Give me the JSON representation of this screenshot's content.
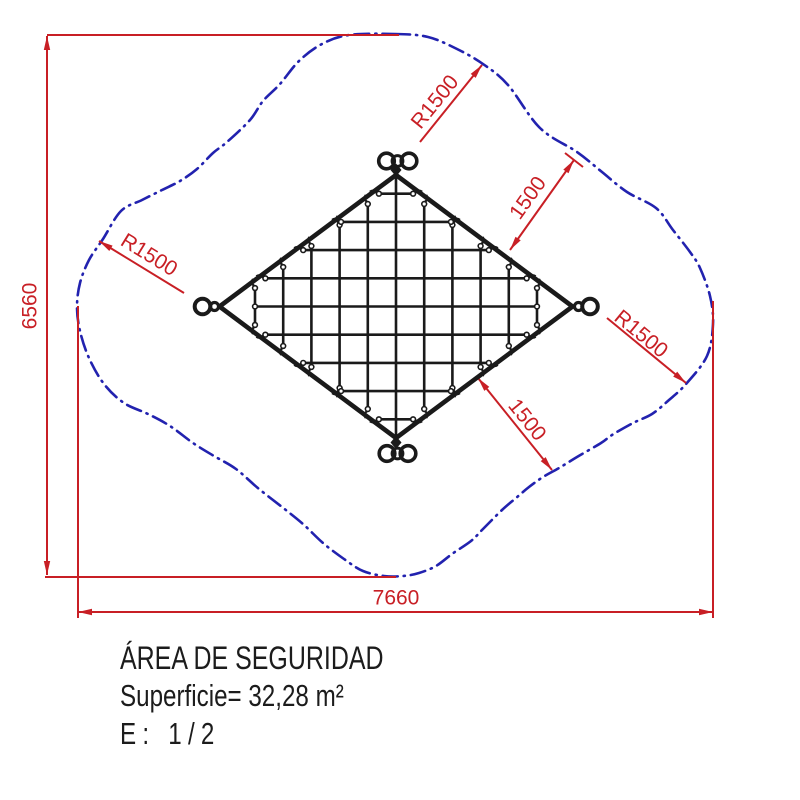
{
  "title_block": {
    "line1": "ÁREA DE SEGURIDAD",
    "line2": "Superficie= 32,28 m²",
    "line3": "E: 1/2"
  },
  "colors": {
    "red": "#c81f25",
    "blue": "#2222af",
    "black": "#1a1a1a",
    "bg": "#ffffff"
  },
  "dimensions": {
    "v6560": {
      "label": "6560",
      "line": [
        47,
        36,
        47,
        575
      ],
      "arrows": [
        [
          47,
          36,
          -90
        ],
        [
          47,
          575,
          90
        ]
      ],
      "ext": [
        [
          47,
          35,
          399,
          35
        ],
        [
          45,
          577,
          396,
          577
        ]
      ],
      "text": {
        "x": 30,
        "y": 306,
        "rot": -90
      }
    },
    "h7660": {
      "label": "7660",
      "line": [
        78,
        612,
        713,
        612
      ],
      "arrows": [
        [
          78,
          612,
          180
        ],
        [
          713,
          612,
          0
        ]
      ],
      "ext": [
        [
          78,
          306,
          78,
          618
        ],
        [
          713,
          301,
          713,
          618
        ]
      ],
      "text": {
        "x": 396,
        "y": 598,
        "rot": 0
      }
    },
    "r1500_ul": {
      "label": "R1500",
      "line": [
        99,
        241,
        184,
        293
      ],
      "arrows": [
        [
          99,
          241,
          211.5
        ]
      ],
      "text": {
        "x": 149,
        "y": 255,
        "rot": 31.5
      }
    },
    "r1500_top": {
      "label": "R1500",
      "line": [
        482,
        65,
        420,
        142
      ],
      "arrows": [
        [
          482,
          65,
          -51.2
        ]
      ],
      "text": {
        "x": 435,
        "y": 102,
        "rot": -51
      }
    },
    "r1500_right": {
      "label": "R1500",
      "line": [
        607,
        318,
        686,
        383
      ],
      "arrows": [
        [
          686,
          383,
          39.4
        ]
      ],
      "text": {
        "x": 641,
        "y": 334,
        "rot": 39.5
      }
    },
    "d1500_top": {
      "label": "1500",
      "line": [
        510,
        250,
        574,
        160
      ],
      "arrows": [
        [
          510,
          250,
          125.4
        ],
        [
          574,
          160,
          -54.6
        ]
      ],
      "tick": [
        565,
        153,
        583,
        167
      ],
      "text": {
        "x": 528,
        "y": 198,
        "rot": -54.5
      }
    },
    "d1500_bottom": {
      "label": "1500",
      "line": [
        478,
        378,
        552,
        470
      ],
      "arrows": [
        [
          478,
          378,
          -128.8
        ],
        [
          552,
          470,
          51.2
        ]
      ],
      "text": {
        "x": 527,
        "y": 420,
        "rot": 51
      }
    }
  },
  "net": {
    "cx": 396,
    "cy": 306.5,
    "halfW": 176.5,
    "halfH": 131.5,
    "spacing": 28.2,
    "vKmax": 5,
    "hKmax": 4,
    "inset": 8,
    "strokes": {
      "edge": 4.6,
      "rope": 2.6
    },
    "knotR": 2.4,
    "rings": {
      "top": [
        [
          386.5,
          161
        ],
        [
          409,
          161
        ]
      ],
      "topMid": [
        397.5,
        161
      ],
      "bottom": [
        [
          387,
          453.5
        ],
        [
          408,
          453.5
        ]
      ],
      "bottomMid": [
        397.5,
        453.5
      ],
      "left": [
        202.5,
        306.5
      ],
      "leftLink": [
        214.5,
        306.5
      ],
      "right": [
        590,
        306.5
      ],
      "rightLink": [
        578.5,
        306.5
      ],
      "ringR": 7.8,
      "midR": 5.4,
      "linkR": 4,
      "ringSW": 3.6,
      "midSW": 3,
      "linkSW": 3.2
    },
    "shackles": [
      [
        396,
        170
      ],
      [
        396,
        442.5
      ]
    ],
    "shackleHalf": [
      5.5,
      6.5
    ]
  },
  "safety_boundary": {
    "dash": [
      15,
      6,
      1.2,
      6
    ],
    "points": [
      [
        395,
        34
      ],
      [
        428,
        37
      ],
      [
        457,
        49
      ],
      [
        483,
        64
      ],
      [
        508,
        85
      ],
      [
        540,
        128
      ],
      [
        577,
        152
      ],
      [
        602,
        172
      ],
      [
        627,
        192
      ],
      [
        656,
        208
      ],
      [
        673,
        230
      ],
      [
        690,
        252
      ],
      [
        700,
        268
      ],
      [
        710,
        296
      ],
      [
        713,
        324
      ],
      [
        707,
        356
      ],
      [
        686,
        384
      ],
      [
        669,
        400
      ],
      [
        652,
        414
      ],
      [
        633,
        423
      ],
      [
        612,
        435
      ],
      [
        601,
        443
      ],
      [
        577,
        457
      ],
      [
        559,
        468
      ],
      [
        543,
        477
      ],
      [
        529,
        487
      ],
      [
        516,
        498
      ],
      [
        502,
        510
      ],
      [
        483,
        529
      ],
      [
        471,
        541
      ],
      [
        452,
        554
      ],
      [
        436,
        566
      ],
      [
        419,
        573
      ],
      [
        403,
        576
      ],
      [
        384,
        576
      ],
      [
        363,
        571
      ],
      [
        344,
        559
      ],
      [
        323,
        543
      ],
      [
        303,
        524
      ],
      [
        282,
        507
      ],
      [
        259,
        489
      ],
      [
        236,
        469
      ],
      [
        214,
        456
      ],
      [
        193,
        443
      ],
      [
        170,
        426
      ],
      [
        148,
        414
      ],
      [
        124,
        403
      ],
      [
        104,
        384
      ],
      [
        89,
        358
      ],
      [
        80,
        331
      ],
      [
        77,
        307
      ],
      [
        80,
        283
      ],
      [
        89,
        260
      ],
      [
        103,
        239
      ],
      [
        121,
        211
      ],
      [
        142,
        200
      ],
      [
        162,
        190
      ],
      [
        180,
        181
      ],
      [
        197,
        169
      ],
      [
        213,
        153
      ],
      [
        227,
        142
      ],
      [
        250,
        120
      ],
      [
        263,
        101
      ],
      [
        280,
        84
      ],
      [
        299,
        61
      ],
      [
        322,
        44
      ],
      [
        349,
        35
      ]
    ]
  }
}
